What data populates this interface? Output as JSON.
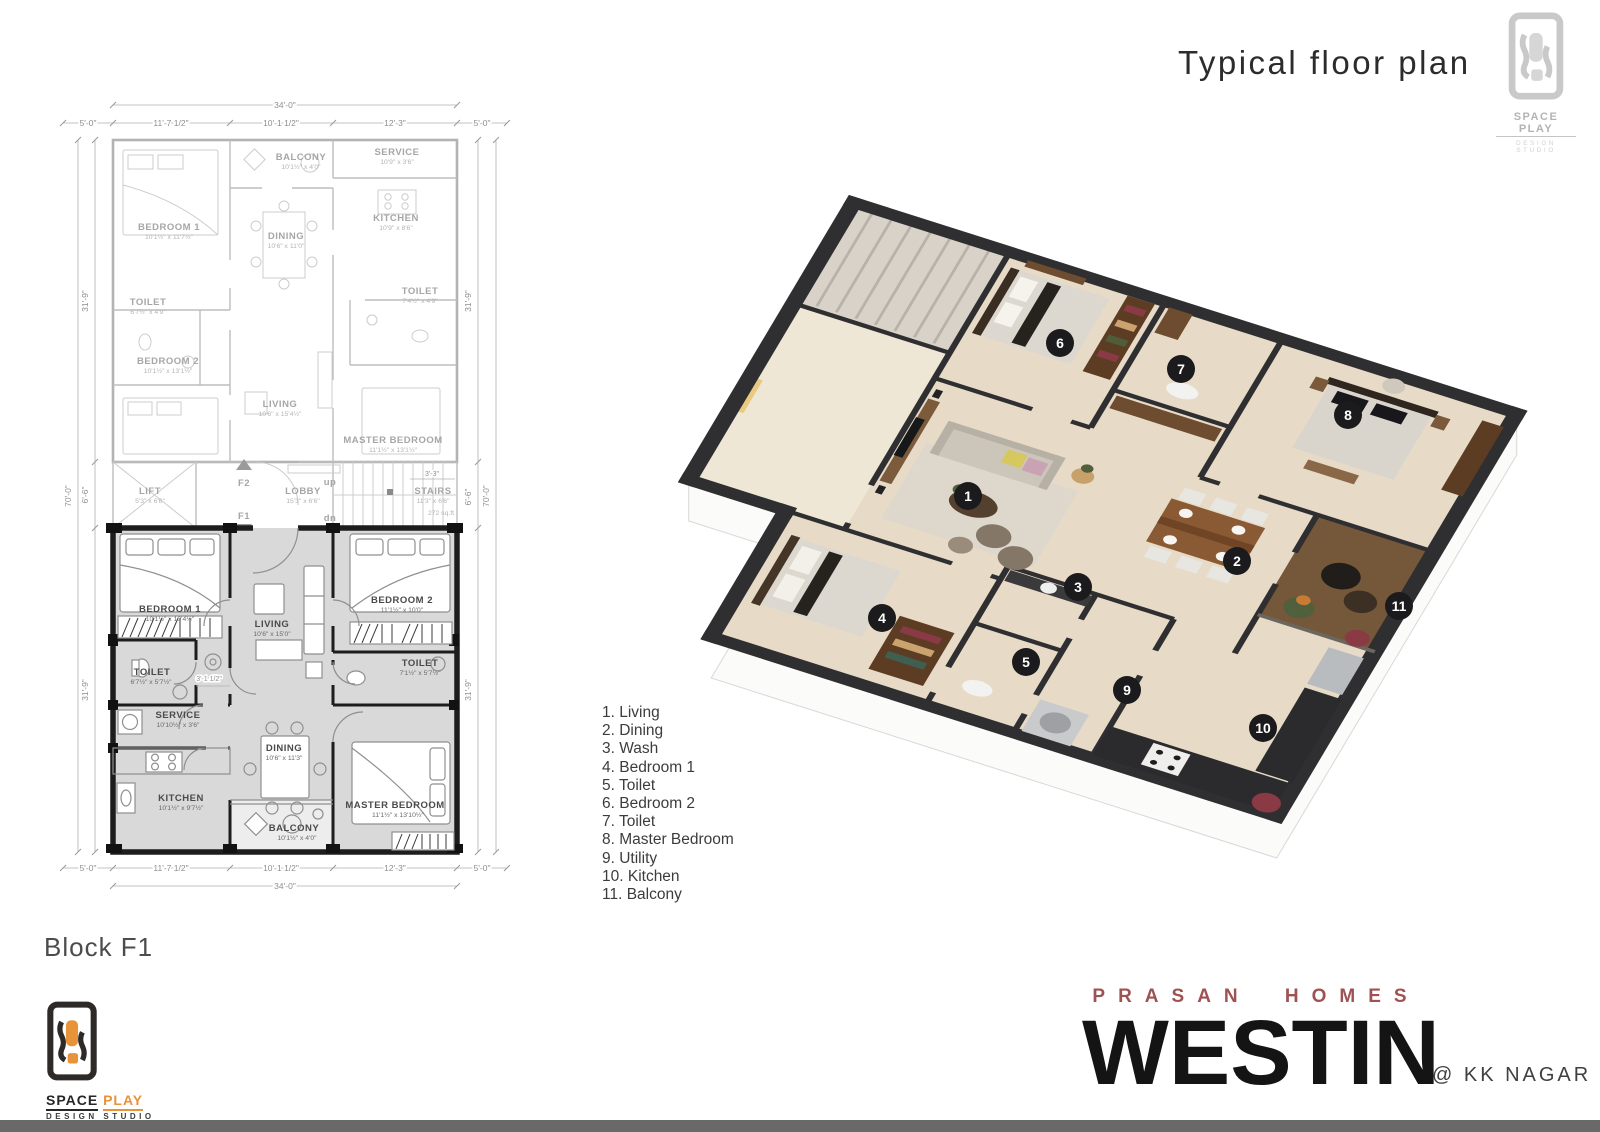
{
  "page": {
    "title": "Typical floor plan",
    "block_label": "Block F1"
  },
  "studio_logo": {
    "name_primary": "SPACE",
    "name_secondary": "PLAY",
    "name_full": "SPACE PLAY",
    "subtitle": "DESIGN STUDIO"
  },
  "brand": {
    "developer": "PRASAN HOMES",
    "project": "WESTIN",
    "location": "@ KK NAGAR"
  },
  "legend": {
    "items": [
      "1. Living",
      "2. Dining",
      "3. Wash",
      "4. Bedroom 1",
      "5. Toilet",
      "6. Bedroom 2",
      "7. Toilet",
      "8. Master Bedroom",
      "9. Utility",
      "10. Kitchen",
      "11. Balcony"
    ]
  },
  "render3d": {
    "badges": [
      "1",
      "2",
      "3",
      "4",
      "5",
      "6",
      "7",
      "8",
      "9",
      "10",
      "11"
    ]
  },
  "plan2d": {
    "dims": {
      "width_total": "34'-0\"",
      "w_left": "5'-0\"",
      "w_bay1": "11'-7 1/2\"",
      "w_bay2": "10'-1 1/2\"",
      "w_bay3": "12'-3\"",
      "w_right": "5'-0\"",
      "height_total": "70'-0\"",
      "h_upper": "31'-9\"",
      "h_lobby": "6'-6\"",
      "h_lower": "31'-9\"",
      "stairs_width": "3'-3\"",
      "passage_width": "3'-1 1/2\""
    },
    "upper": {
      "rooms": [
        {
          "name": "BALCONY",
          "size": "10'1½\" x 4'0\""
        },
        {
          "name": "SERVICE",
          "size": "10'9\" x 3'6\""
        },
        {
          "name": "KITCHEN",
          "size": "10'9\" x 8'6\""
        },
        {
          "name": "BEDROOM 1",
          "size": "10'1½\" x 11'7½\""
        },
        {
          "name": "DINING",
          "size": "10'6\" x 11'0\""
        },
        {
          "name": "TOILET",
          "size": "6'7½\" x 4'9\""
        },
        {
          "name": "TOILET",
          "size": "7'4½\" x 4'9\""
        },
        {
          "name": "BEDROOM 2",
          "size": "10'1½\" x 13'1½\""
        },
        {
          "name": "LIVING",
          "size": "10'6\" x 15'4½\""
        },
        {
          "name": "MASTER BEDROOM",
          "size": "11'1½\" x 13'1½\""
        }
      ]
    },
    "lobby": {
      "lift": {
        "name": "LIFT",
        "size": "5'3\" x 6'6\""
      },
      "hall": {
        "name": "LOBBY",
        "size": "15'3\" x 6'6\""
      },
      "stairs": {
        "name": "STAIRS",
        "size": "11'3\" x 6'6\"",
        "area": "272 sq.ft"
      },
      "marker_f2": "F2",
      "marker_f1": "F1",
      "up_label": "up",
      "down_label": "dn"
    },
    "lower": {
      "rooms": [
        {
          "name": "BEDROOM 1",
          "size": "10'1½\" x 10'4½\""
        },
        {
          "name": "LIVING",
          "size": "10'6\" x 15'0\""
        },
        {
          "name": "BEDROOM 2",
          "size": "11'1½\" x 10'0\""
        },
        {
          "name": "TOILET",
          "size": "6'7½\" x 5'7½\""
        },
        {
          "name": "TOILET",
          "size": "7'1½\" x 5'7½\""
        },
        {
          "name": "SERVICE",
          "size": "10'10½\" x 3'6\""
        },
        {
          "name": "DINING",
          "size": "10'6\" x 11'3\""
        },
        {
          "name": "KITCHEN",
          "size": "10'1½\" x 9'7½\""
        },
        {
          "name": "MASTER BEDROOM",
          "size": "11'1½\" x 13'10½\""
        },
        {
          "name": "BALCONY",
          "size": "10'1½\" x 4'0\""
        }
      ]
    }
  },
  "colors": {
    "brand_red": "#9e5252",
    "accent_orange": "#e8923a",
    "wall_dark": "#1d1d1f",
    "floor_gray": "#d9d9d9",
    "floor_beige": "#e7dbc7",
    "footer_gray": "#696969"
  }
}
